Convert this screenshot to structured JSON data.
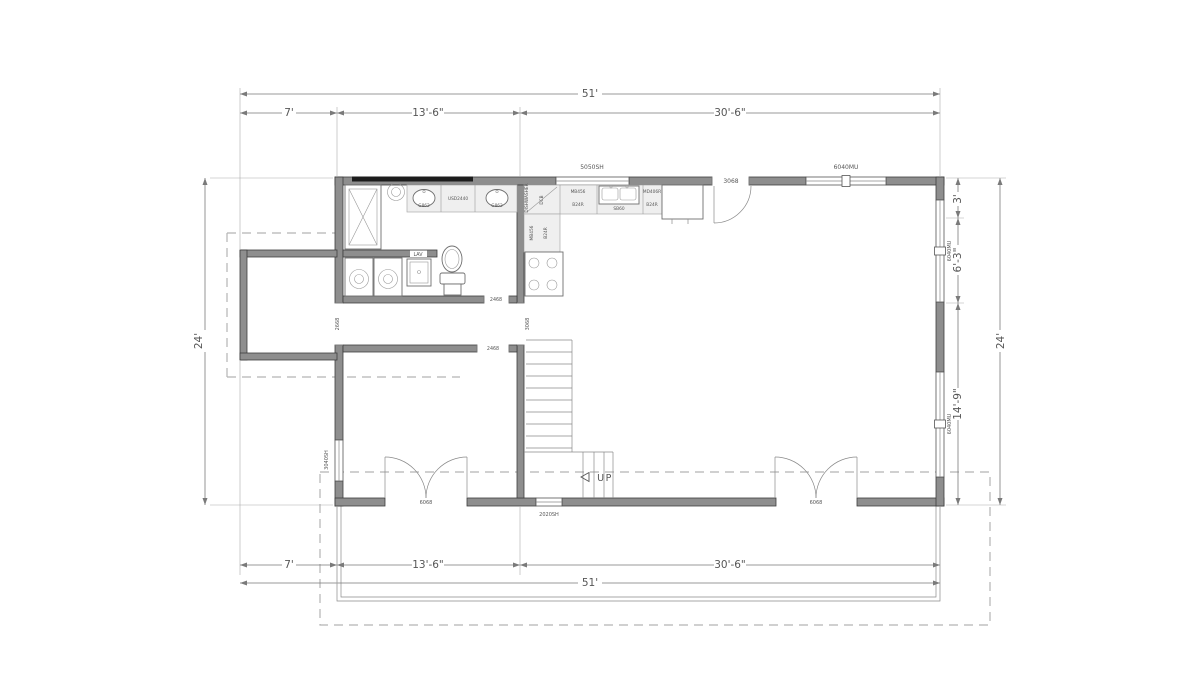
{
  "palette": {
    "wall_fill": "#8e8e8e",
    "wall_edge": "#3e3e3e",
    "dimension_line": "#7a7a7a",
    "dashed_overhang": "#b4b4b4",
    "text": "#565656",
    "mirror": "#1c1c1c",
    "counter": "#efefef"
  },
  "dimensions": {
    "top": {
      "overall": "51'",
      "segments": [
        "7'",
        "13'-6\"",
        "30'-6\""
      ]
    },
    "bottom": {
      "overall": "51'",
      "segments": [
        "7'",
        "13'-6\"",
        "30'-6\""
      ]
    },
    "left": {
      "overall": "24'"
    },
    "right": {
      "overall": "24'",
      "segments": [
        "3'",
        "6'-3\"",
        "14'-9\""
      ]
    }
  },
  "openings": {
    "top_window1": "5050SH",
    "top_door": "3068",
    "top_window2": "6040MU",
    "right_window1": "6040MU",
    "right_window2": "6040MU",
    "left_window": "3040SH",
    "left_room_door": "2668",
    "bottom_door1": "6068",
    "bottom_window": "2020SH",
    "bottom_door2": "6068",
    "bath_door": "2468",
    "hall_door": "2468",
    "hall_opening": "3068"
  },
  "labels": {
    "dishwasher": "DISHWASHER",
    "corner_cabinet": "DCB",
    "wall_cabinet": "MB456",
    "base_cabinet": "B24R",
    "kitchen_sink": "SB60",
    "cabinet_right": "MD406R",
    "base_cabinet2": "B24R",
    "leg_wall_cabinet": "MB456",
    "leg_base_cabinet": "B24R",
    "vanity_left_sink": "G862",
    "vanity_right_sink": "G862",
    "vanity_center": "USD2440",
    "laundry_sink": "LAV",
    "stairs": "UP"
  }
}
